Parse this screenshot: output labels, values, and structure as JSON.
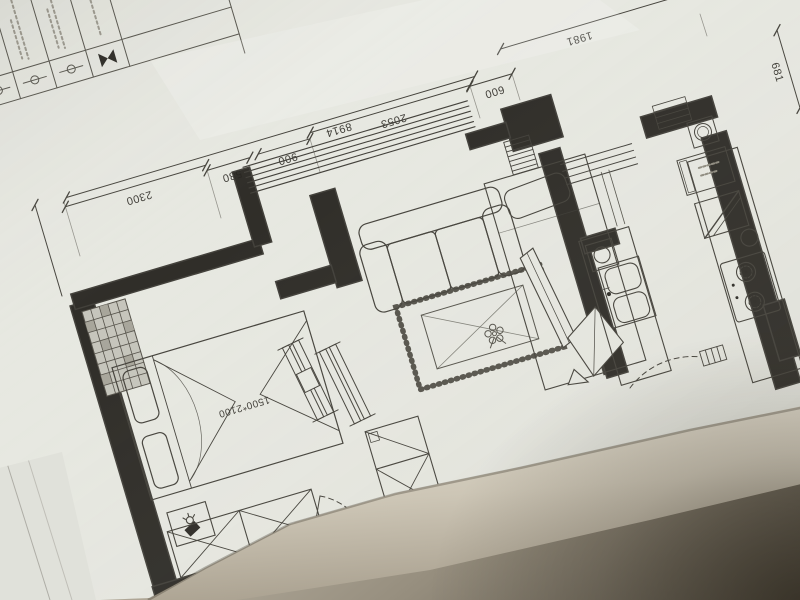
{
  "dimensions": {
    "d2300": "2300",
    "d580": "580",
    "d900": "900",
    "d8914": "8914",
    "d2053": "2053",
    "d600": "600",
    "d1981": "1981",
    "d681": "681"
  },
  "labels": {
    "bed_size": "1500*2100"
  },
  "legend": {
    "symbol_icons": [
      "circle-inline-symbol",
      "circle-inline-symbol",
      "circle-inline-symbol",
      "bowtie-symbol"
    ]
  },
  "colors": {
    "paper": "#e7e8e1",
    "ink": "#45433c",
    "wall_ink": "#26241f",
    "desk_light": "#d8d2c6",
    "desk_dark": "#554f44"
  }
}
